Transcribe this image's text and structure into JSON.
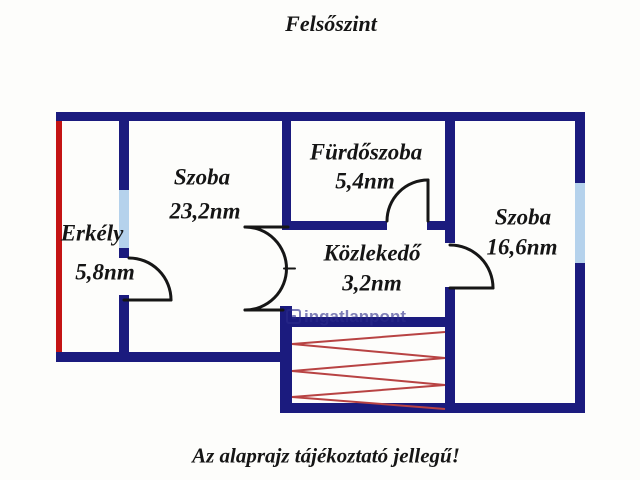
{
  "page": {
    "title": "Felsőszint",
    "caption": "Az alaprajz tájékoztató jellegű!"
  },
  "rooms": [
    {
      "name": "Erkély",
      "area": "5,8nm"
    },
    {
      "name": "Szoba",
      "area": "23,2nm"
    },
    {
      "name": "Fürdőszoba",
      "area": "5,4nm"
    },
    {
      "name": "Közlekedő",
      "area": "3,2nm"
    },
    {
      "name": "Szoba",
      "area": "16,6nm"
    }
  ],
  "watermark": {
    "brand": "ingatlanpont"
  },
  "colors": {
    "wall": "#1b1b7e",
    "window": "#b5d2ec",
    "balcony_edge": "#c41414",
    "stairs": "#b84343",
    "door": "#161616",
    "label_text": "#151515",
    "watermark": "#2b2b8a"
  }
}
